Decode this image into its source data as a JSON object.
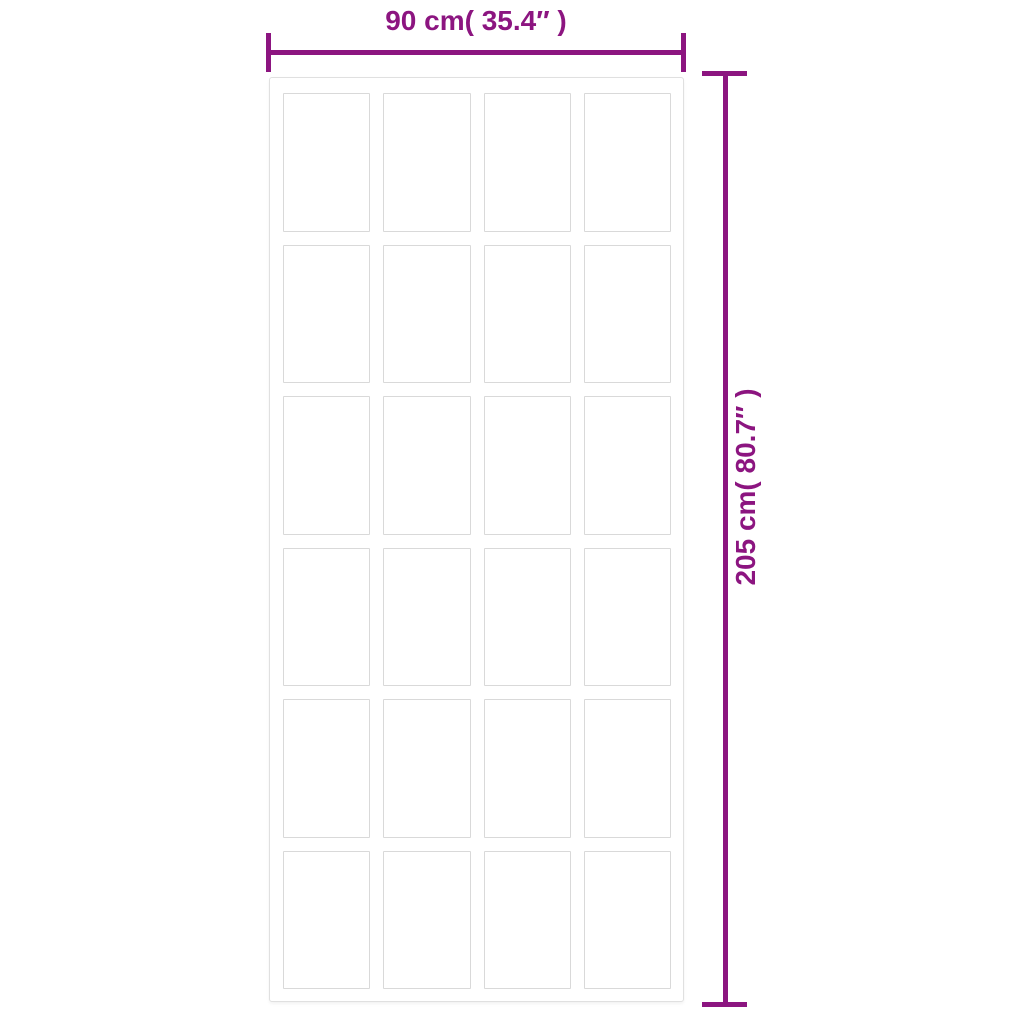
{
  "diagram": {
    "type": "product-dimension-diagram",
    "subject": "sliding door with paneled glass inserts",
    "width_dimension": {
      "label": "90 cm( 35.4″ )",
      "value_cm": 90,
      "value_inch": 35.4
    },
    "height_dimension": {
      "label": "205 cm( 80.7″ )",
      "value_cm": 205,
      "value_inch": 80.7
    },
    "grid": {
      "columns": 4,
      "rows": 6,
      "panel_count": 24
    },
    "colors": {
      "dimension": "#8c1580",
      "background": "#ffffff",
      "door_border": "#e0e0e0",
      "panel_border": "#d9d9d9"
    }
  }
}
